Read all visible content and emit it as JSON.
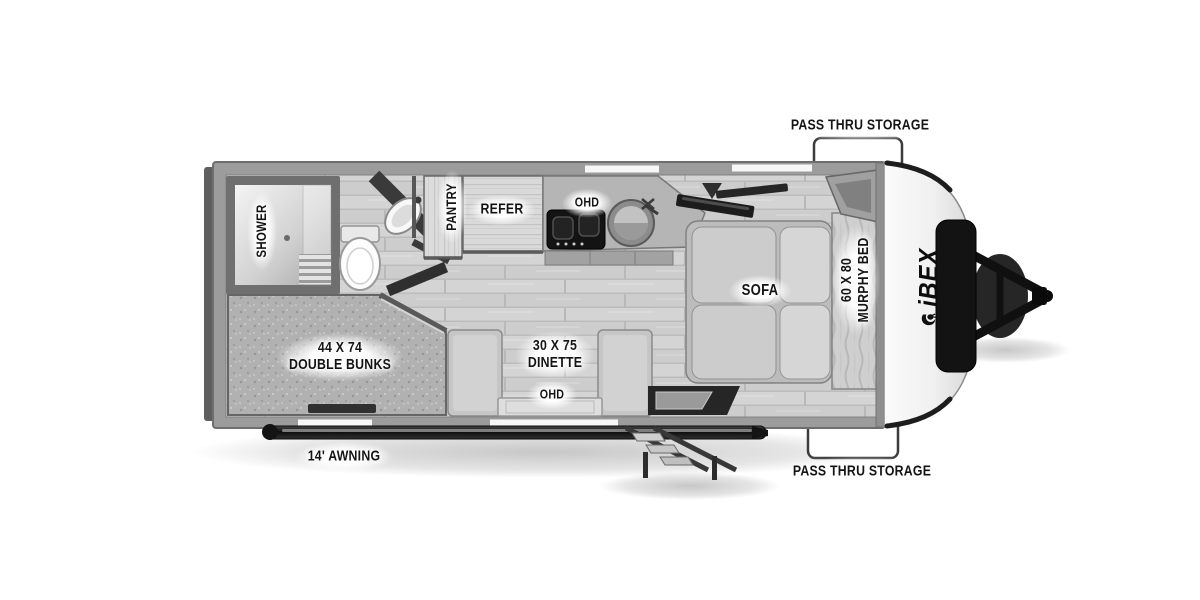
{
  "brand": {
    "logo_text": "iBEX"
  },
  "exterior": {
    "storage_top_label": "PASS THRU STORAGE",
    "storage_bottom_label": "PASS THRU STORAGE",
    "awning_label": "14' AWNING"
  },
  "interior": {
    "shower_label": "SHOWER",
    "pantry_label": "PANTRY",
    "refrigerator_label": "REFER",
    "kitchen_overhead_label": "OHD",
    "sofa_label": "SOFA",
    "murphy_bed": {
      "size": "60 X 80",
      "name": "MURPHY BED"
    },
    "double_bunks": {
      "size": "44 X 74",
      "name": "DOUBLE BUNKS"
    },
    "dinette": {
      "size": "30 X 75",
      "name": "DINETTE"
    },
    "dinette_overhead_label": "OHD"
  },
  "colors": {
    "background": "#ffffff",
    "wall_gray": "#9c9c9c",
    "floor_gray": "#d2d2d2",
    "fixture_dark": "#1a1a1a",
    "label_text": "#141414",
    "cap_white": "#f6f6f6"
  }
}
